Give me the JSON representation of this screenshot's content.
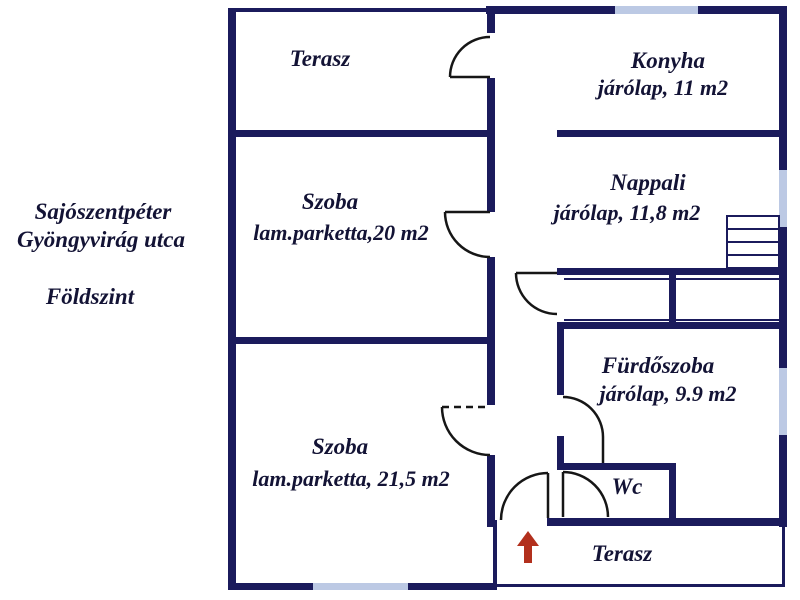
{
  "title": "floor-plan",
  "address": {
    "city": "Sajószentpéter",
    "street": "Gyöngyvirág utca",
    "floor": "Földszint"
  },
  "rooms": {
    "terasz_top": {
      "name": "Terasz"
    },
    "konyha": {
      "name": "Konyha",
      "detail": "járólap, 11 m2"
    },
    "szoba_20": {
      "name": "Szoba",
      "detail": "lam.parketta,20 m2"
    },
    "nappali": {
      "name": "Nappali",
      "detail": "járólap, 11,8 m2"
    },
    "furdoszoba": {
      "name": "Fürdőszoba",
      "detail": "járólap, 9.9 m2"
    },
    "szoba_21": {
      "name": "Szoba",
      "detail": "lam.parketta, 21,5 m2"
    },
    "wc": {
      "name": "Wc"
    },
    "terasz_bottom": {
      "name": "Terasz"
    }
  },
  "icons": {
    "entrance_arrow": "up-arrow"
  },
  "colors": {
    "wall": "#1b1b5c",
    "window": "#bcc9e4",
    "door_line": "#161616",
    "entrance_arrow": "#b2301d",
    "text": "#131335",
    "background": "#ffffff"
  }
}
